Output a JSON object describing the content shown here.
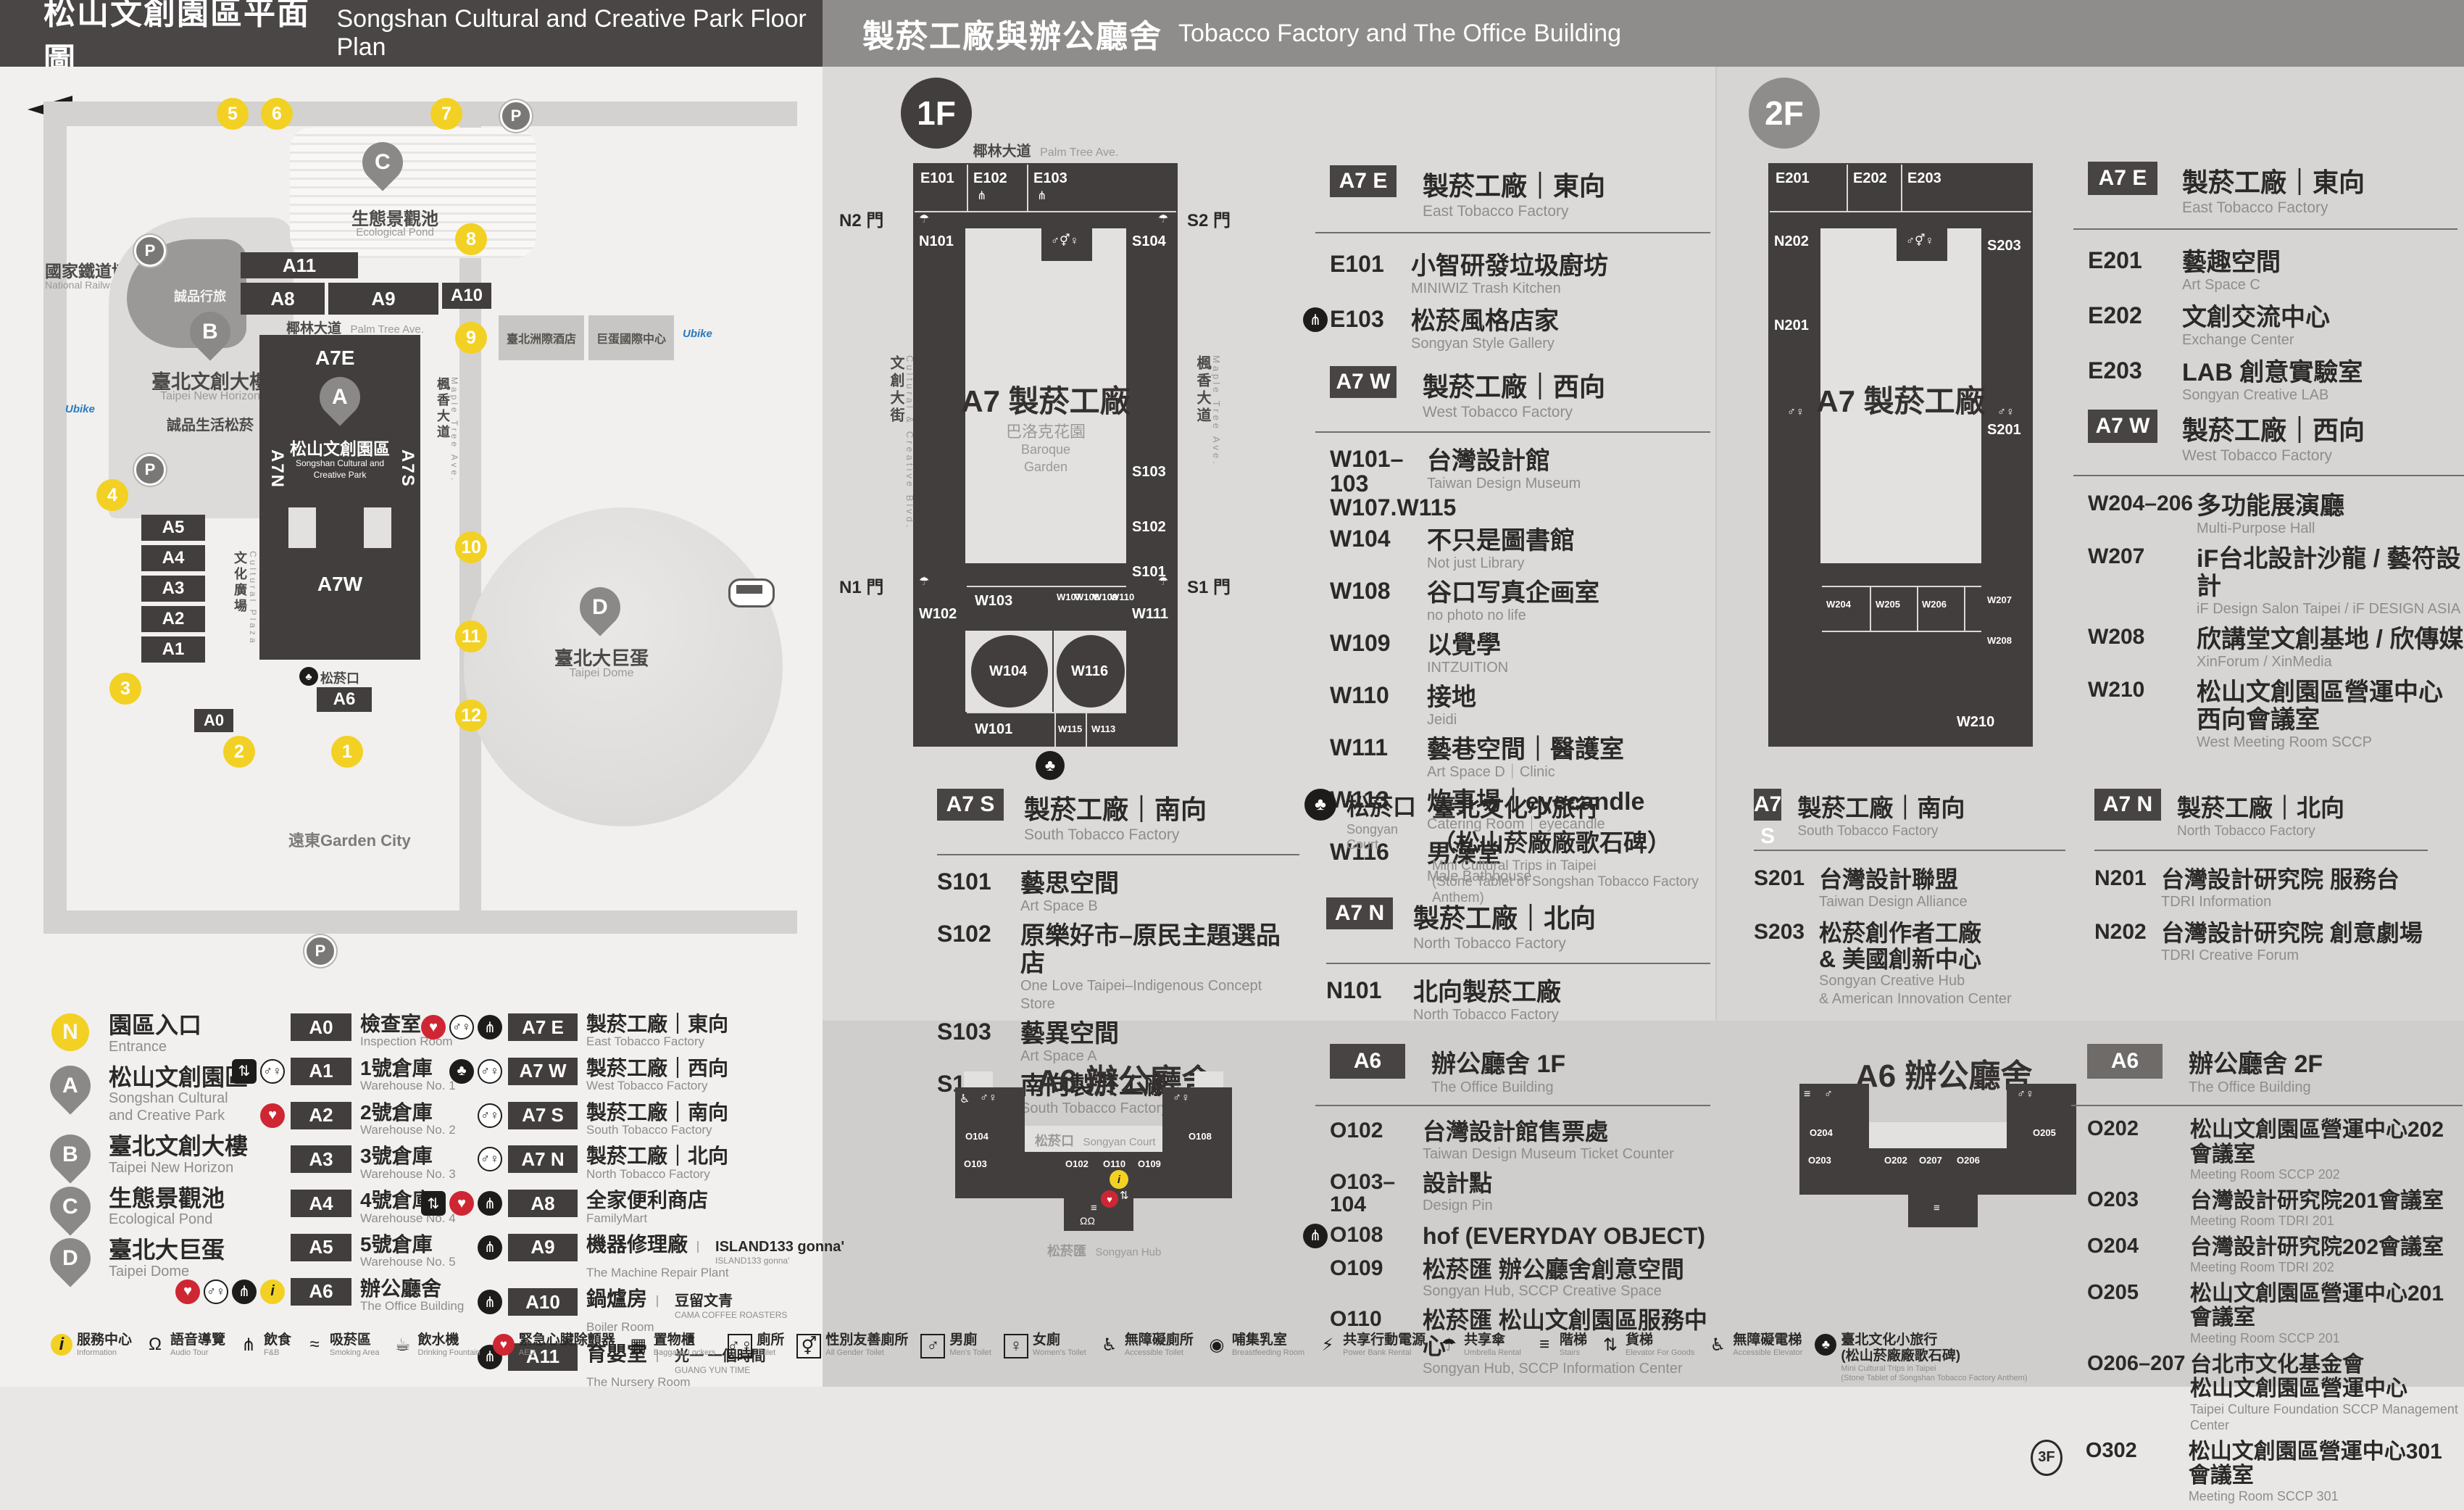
{
  "colors": {
    "accent_yellow": "#f2d124",
    "aed_red": "#cf2633",
    "dark": "#413e3d",
    "header_left_bg": "#4a4646",
    "header_right_bg": "#8f8d8b"
  },
  "icon_glyphs": {
    "information": "i",
    "audio-tour": "Ω",
    "fnb": "⋔",
    "smoking-area": "≈",
    "drinking-fountain": "☕",
    "aed": "♥",
    "baggage-lockers": "▦",
    "toilet": "♂♀",
    "all-gender-toilet": "⚥",
    "mens-toilet": "♂",
    "womens-toilet": "♀",
    "accessible-toilet": "♿",
    "breastfeeding-room": "◉",
    "power-bank-rental": "⚡",
    "umbrella-rental": "☂",
    "stairs": "≡",
    "elevator-for-goods": "⇅",
    "accessible-elevator": "♿",
    "court": "♣",
    "elevator": "⇅",
    "mini-cultural-trips": "♣",
    "parking": "P"
  },
  "header": {
    "left_zh": "松山文創園區平面圖",
    "left_en": "Songshan Cultural and Creative Park Floor Plan",
    "right_zh": "製菸工廠與辦公廳舍",
    "right_en": "Tobacco Factory and The Office Building"
  },
  "map": {
    "railway_museum_zh": "國家鐵道博物館",
    "railway_museum_en": "National Railway Museum",
    "eslite_hotel_zh": "誠品行旅",
    "b_zh": "臺北文創大樓",
    "b_en": "Taipei New Horizon",
    "eslite_store_zh": "誠品生活松菸",
    "c_zh": "生態景觀池",
    "c_en": "Ecological Pond",
    "a_zh": "松山文創園區",
    "a_en1": "Songshan Cultural and",
    "a_en2": "Creative Park",
    "d_zh": "臺北大巨蛋",
    "d_en": "Taipei Dome",
    "hotel_zh": "臺北洲際酒店",
    "dome_center_zh": "巨蛋國際中心",
    "garden_city": "遠東Garden City",
    "court_zh": "松菸口",
    "palm_zh": "椰林大道",
    "palm_en": "Palm Tree Ave.",
    "plaza_zh": "文化廣場",
    "plaza_en": "Cultural Plaza",
    "ccblvd_zh": "文創大街",
    "ccblvd_en": "Cultural & Creative Blvd.",
    "maple_zh": "楓香大道",
    "maple_en": "Maple Tree Ave.",
    "ubike": "Ubike",
    "parking_label": "P",
    "stops": [
      "1",
      "2",
      "3",
      "4",
      "5",
      "6",
      "7",
      "8",
      "9",
      "10",
      "11",
      "12"
    ],
    "bld": {
      "a0": "A0",
      "a1": "A1",
      "a2": "A2",
      "a3": "A3",
      "a4": "A4",
      "a5": "A5",
      "a6": "A6",
      "a8": "A8",
      "a9": "A9",
      "a10": "A10",
      "a11": "A11",
      "a7e": "A7E",
      "a7w": "A7W",
      "a7n": "A7N",
      "a7s": "A7S"
    }
  },
  "floor1": {
    "badge": "1F",
    "plan": {
      "street_top_zh": "椰林大道",
      "street_top_en": "Palm Tree Ave.",
      "street_left_zh": "文創大街",
      "street_left_en": "Cultural & Creative Blvd.",
      "street_right_zh": "楓香大道",
      "street_right_en": "Maple Tree Ave.",
      "center_title": "A7 製菸工廠",
      "garden_zh": "巴洛克花園",
      "garden_en1": "Baroque",
      "garden_en2": "Garden",
      "gates": {
        "n2": "N2 門",
        "s2": "S2 門",
        "n1": "N1 門",
        "s1": "S1 門"
      },
      "rooms": {
        "e101": "E101",
        "e102": "E102",
        "e103": "E103",
        "n101": "N101",
        "s104": "S104",
        "s103": "S103",
        "s102": "S102",
        "s101": "S101",
        "w102": "W102",
        "w103": "W103",
        "w107": "W107",
        "w108": "W108",
        "w109": "W109",
        "w110": "W110",
        "w111": "W111",
        "w104": "W104",
        "w116": "W116",
        "w101": "W101",
        "w115": "W115",
        "w113": "W113"
      }
    },
    "sections": [
      {
        "badge": "A7 E",
        "zh": "製菸工廠｜東向",
        "en": "East Tobacco Factory",
        "items": [
          {
            "code": "E101",
            "zh": "小智研發垃圾廚坊",
            "en": "MINIWIZ Trash Kitchen",
            "icons": []
          },
          {
            "code": "E103",
            "zh": "松菸風格店家",
            "en": "Songyan Style Gallery",
            "icons": [
              "fnb"
            ]
          }
        ]
      },
      {
        "badge": "A7 W",
        "zh": "製菸工廠｜西向",
        "en": "West Tobacco Factory",
        "items": [
          {
            "code": "W101–103",
            "code2": "W107.W115",
            "zh": "台灣設計館",
            "en": "Taiwan Design Museum",
            "icons": []
          },
          {
            "code": "W104",
            "zh": "不只是圖書館",
            "en": "Not just Library",
            "icons": []
          },
          {
            "code": "W108",
            "zh": "谷口写真企画室",
            "en": "no photo no life",
            "icons": []
          },
          {
            "code": "W109",
            "zh": "以覺學",
            "en": "INTZUITION",
            "icons": []
          },
          {
            "code": "W110",
            "zh": "接地",
            "en": "Jeidi",
            "icons": []
          },
          {
            "code": "W111",
            "zh": "藝巷空間｜醫護室",
            "en": "Art Space D｜Clinic",
            "icons": []
          },
          {
            "code": "W113",
            "zh": "炊事場｜eyecandle",
            "en": "Catering Room｜eyecandle",
            "icons": []
          },
          {
            "code": "W116",
            "zh": "男澡堂",
            "en": "Male Bathhouse",
            "icons": []
          }
        ]
      },
      {
        "badge": "A7 S",
        "zh": "製菸工廠｜南向",
        "en": "South Tobacco Factory",
        "items": [
          {
            "code": "S101",
            "zh": "藝思空間",
            "en": "Art Space B",
            "icons": []
          },
          {
            "code": "S102",
            "zh": "原樂好市–原民主題選品店",
            "en": "One Love Taipei–Indigenous Concept Store",
            "icons": []
          },
          {
            "code": "S103",
            "zh": "藝異空間",
            "en": "Art Space A",
            "icons": []
          },
          {
            "code": "S104",
            "zh": "南向製菸工廠",
            "en": "South Tobacco Factory",
            "icons": []
          }
        ]
      },
      {
        "badge": "A7 N",
        "zh": "製菸工廠｜北向",
        "en": "North Tobacco Factory",
        "items": [
          {
            "code": "N101",
            "zh": "北向製菸工廠",
            "en": "North Tobacco Factory",
            "icons": []
          }
        ]
      }
    ],
    "court": {
      "zh": "松菸口",
      "en": "Songyan Court",
      "item_zh1": "臺北文化小旅行",
      "item_zh2": "（松山菸廠廠歌石碑）",
      "item_en1": "Mini Cultural Trips in Taipei",
      "item_en2": "(Stone Tablet of Songshan Tobacco Factory Anthem)"
    }
  },
  "floor2": {
    "badge": "2F",
    "plan": {
      "center_title": "A7 製菸工廠",
      "rooms": {
        "e201": "E201",
        "e202": "E202",
        "e203": "E203",
        "n202": "N202",
        "n201": "N201",
        "s203": "S203",
        "s201": "S201",
        "w204": "W204",
        "w205": "W205",
        "w206": "W206",
        "w207": "W207",
        "w208": "W208",
        "w210": "W210"
      }
    },
    "sections": [
      {
        "badge": "A7 E",
        "zh": "製菸工廠｜東向",
        "en": "East Tobacco Factory",
        "items": [
          {
            "code": "E201",
            "zh": "藝趣空間",
            "en": "Art Space C",
            "icons": []
          },
          {
            "code": "E202",
            "zh": "文創交流中心",
            "en": "Exchange Center",
            "icons": []
          },
          {
            "code": "E203",
            "zh": "LAB 創意實驗室",
            "en": "Songyan Creative LAB",
            "icons": []
          }
        ]
      },
      {
        "badge": "A7 W",
        "zh": "製菸工廠｜西向",
        "en": "West Tobacco Factory",
        "items": [
          {
            "code": "W204–206",
            "zh": "多功能展演廳",
            "en": "Multi-Purpose Hall",
            "icons": []
          },
          {
            "code": "W207",
            "zh": "iF台北設計沙龍 / 藝符設計",
            "en": "iF Design Salon Taipei / iF DESIGN ASIA",
            "icons": []
          },
          {
            "code": "W208",
            "zh": "欣講堂文創基地 / 欣傳媒",
            "en": "XinForum / XinMedia",
            "icons": []
          },
          {
            "code": "W210",
            "zh": "松山文創園區營運中心",
            "zh2": "西向會議室",
            "en": "West Meeting Room SCCP",
            "icons": []
          }
        ]
      },
      {
        "badge": "A7 S",
        "zh": "製菸工廠｜南向",
        "en": "South Tobacco Factory",
        "items": [
          {
            "code": "S201",
            "zh": "台灣設計聯盟",
            "en": "Taiwan Design Alliance",
            "icons": []
          },
          {
            "code": "S203",
            "zh": "松菸創作者工廠",
            "zh2": "& 美國創新中心",
            "en": "Songyan Creative Hub",
            "en2": "& American Innovation Center",
            "icons": []
          }
        ]
      },
      {
        "badge": "A7 N",
        "zh": "製菸工廠｜北向",
        "en": "North Tobacco Factory",
        "items": [
          {
            "code": "N201",
            "zh": "台灣設計研究院 服務台",
            "en": "TDRI Information",
            "icons": []
          },
          {
            "code": "N202",
            "zh": "台灣設計研究院 創意劇場",
            "en": "TDRI Creative Forum",
            "icons": []
          }
        ]
      }
    ]
  },
  "office1f": {
    "badge": "A6",
    "zh": "辦公廳舍 1F",
    "en": "The Office Building",
    "plan": {
      "title": "A6 辦公廳舍",
      "court_zh": "松菸口",
      "court_en": "Songyan Court",
      "hub_zh": "松菸匯",
      "hub_en": "Songyan Hub",
      "rooms": {
        "o104": "O104",
        "o103": "O103",
        "o102": "O102",
        "o110": "O110",
        "o109": "O109",
        "o108": "O108"
      }
    },
    "items": [
      {
        "code": "O102",
        "zh": "台灣設計館售票處",
        "en": "Taiwan Design Museum Ticket Counter",
        "icons": []
      },
      {
        "code": "O103–104",
        "zh": "設計點",
        "en": "Design Pin",
        "icons": []
      },
      {
        "code": "O108",
        "zh": "hof (EVERYDAY OBJECT)",
        "icons": [
          "fnb"
        ]
      },
      {
        "code": "O109",
        "zh": "松菸匯 辦公廳舍創意空間",
        "en": "Songyan Hub, SCCP Creative Space",
        "icons": []
      },
      {
        "code": "O110",
        "zh": "松菸匯 松山文創園區服務中心",
        "en": "Songyan Hub, SCCP Information Center",
        "icons": []
      }
    ]
  },
  "office2f": {
    "badge": "A6",
    "zh": "辦公廳舍 2F",
    "en": "The Office Building",
    "plan": {
      "title": "A6 辦公廳舍",
      "rooms": {
        "o204": "O204",
        "o203": "O203",
        "o202": "O202",
        "o207": "O207",
        "o206": "O206",
        "o205": "O205"
      }
    },
    "items": [
      {
        "code": "O202",
        "zh": "松山文創園區營運中心202會議室",
        "en": "Meeting Room SCCP 202",
        "icons": []
      },
      {
        "code": "O203",
        "zh": "台灣設計研究院201會議室",
        "en": "Meeting Room TDRI 201",
        "icons": []
      },
      {
        "code": "O204",
        "zh": "台灣設計研究院202會議室",
        "en": "Meeting Room TDRI 202",
        "icons": []
      },
      {
        "code": "O205",
        "zh": "松山文創園區營運中心201會議室",
        "en": "Meeting Room SCCP 201",
        "icons": []
      },
      {
        "code": "O206–207",
        "zh": "台北市文化基金會",
        "zh2": "松山文創園區營運中心",
        "en": "Taipei Culture Foundation SCCP Management Center",
        "icons": []
      },
      {
        "code": "O302",
        "prefix": "3F",
        "zh": "松山文創園區營運中心301會議室",
        "en": "Meeting Room SCCP 301",
        "icons": []
      }
    ]
  },
  "legend": {
    "points": [
      {
        "key": "N",
        "circle": "y",
        "zh": "園區入口",
        "en": "Entrance"
      },
      {
        "key": "A",
        "pin": "y",
        "zh": "松山文創園區",
        "en": "Songshan Cultural",
        "en2": "and Creative Park"
      },
      {
        "key": "B",
        "pin": "y",
        "zh": "臺北文創大樓",
        "en": "Taipei New Horizon"
      },
      {
        "key": "C",
        "pin": "y",
        "zh": "生態景觀池",
        "en": "Ecological Pond"
      },
      {
        "key": "D",
        "pin": "y",
        "zh": "臺北大巨蛋",
        "en": "Taipei Dome"
      }
    ],
    "buildings": [
      {
        "code": "A0",
        "zh": "檢查室",
        "en": "Inspection Room",
        "icons": []
      },
      {
        "code": "A1",
        "zh": "1號倉庫",
        "en": "Warehouse No. 1",
        "icons": [
          "elevator",
          "toilet"
        ]
      },
      {
        "code": "A2",
        "zh": "2號倉庫",
        "en": "Warehouse No. 2",
        "icons": [
          "aed"
        ]
      },
      {
        "code": "A3",
        "zh": "3號倉庫",
        "en": "Warehouse No. 3",
        "icons": []
      },
      {
        "code": "A4",
        "zh": "4號倉庫",
        "en": "Warehouse No. 4",
        "icons": []
      },
      {
        "code": "A5",
        "zh": "5號倉庫",
        "en": "Warehouse No. 5",
        "icons": []
      },
      {
        "code": "A6",
        "zh": "辦公廳舍",
        "en": "The Office Building",
        "icons": [
          "aed",
          "toilet",
          "fnb",
          "information"
        ]
      }
    ],
    "factory": [
      {
        "code": "A7 E",
        "zh": "製菸工廠｜東向",
        "en": "East Tobacco Factory",
        "icons": [
          "aed",
          "toilet",
          "fnb"
        ]
      },
      {
        "code": "A7 W",
        "zh": "製菸工廠｜西向",
        "en": "West Tobacco Factory",
        "icons": [
          "court",
          "toilet"
        ]
      },
      {
        "code": "A7 S",
        "zh": "製菸工廠｜南向",
        "en": "South Tobacco Factory",
        "icons": [
          "toilet"
        ]
      },
      {
        "code": "A7 N",
        "zh": "製菸工廠｜北向",
        "en": "North Tobacco Factory",
        "icons": [
          "toilet"
        ]
      },
      {
        "code": "A8",
        "zh": "全家便利商店",
        "en": "FamilyMart",
        "icons": [
          "elevator",
          "aed",
          "fnb"
        ]
      },
      {
        "code": "A9",
        "zh": "機器修理廠",
        "en": "The Machine Repair Plant",
        "brand": "ISLAND133 gonna'",
        "brand_sub": "ISLAND133 gonna'",
        "icons": [
          "fnb"
        ]
      },
      {
        "code": "A10",
        "zh": "鍋爐房",
        "en": "Boiler Room",
        "brand": "豆留文青",
        "brand_sub": "CAMA COFFEE ROASTERS",
        "icons": [
          "fnb"
        ]
      },
      {
        "code": "A11",
        "zh": "育嬰室",
        "en": "The Nursery Room",
        "brand": "光一 一個時間",
        "brand_sub": "GUANG YUN TIME",
        "icons": [
          "fnb"
        ]
      }
    ]
  },
  "footer": [
    {
      "icon": "information",
      "zh": "服務中心",
      "en": "Information"
    },
    {
      "icon": "audio-tour",
      "zh": "語音導覽",
      "en": "Audio Tour"
    },
    {
      "icon": "fnb",
      "zh": "飲食",
      "en": "F&B"
    },
    {
      "icon": "smoking-area",
      "zh": "吸菸區",
      "en": "Smoking Area"
    },
    {
      "icon": "drinking-fountain",
      "zh": "飲水機",
      "en": "Drinking Fountain"
    },
    {
      "icon": "aed",
      "zh": "緊急心臟除顫器",
      "en": "AED"
    },
    {
      "icon": "baggage-lockers",
      "zh": "置物櫃",
      "en": "Baggage Lockers"
    },
    {
      "icon": "toilet",
      "zh": "廁所",
      "en": "Toilet"
    },
    {
      "icon": "all-gender-toilet",
      "zh": "性別友善廁所",
      "en": "All Gender Toilet"
    },
    {
      "icon": "mens-toilet",
      "zh": "男廁",
      "en": "Men's Toilet"
    },
    {
      "icon": "womens-toilet",
      "zh": "女廁",
      "en": "Women's Toilet"
    },
    {
      "icon": "accessible-toilet",
      "zh": "無障礙廁所",
      "en": "Accessible Toilet"
    },
    {
      "icon": "breastfeeding-room",
      "zh": "哺集乳室",
      "en": "Breastfeeding Room"
    },
    {
      "icon": "power-bank-rental",
      "zh": "共享行動電源",
      "en": "Power Bank Rental"
    },
    {
      "icon": "umbrella-rental",
      "zh": "共享傘",
      "en": "Umbrella Rental"
    },
    {
      "icon": "stairs",
      "zh": "階梯",
      "en": "Stairs"
    },
    {
      "icon": "elevator-for-goods",
      "zh": "貨梯",
      "en": "Elevator For Goods"
    },
    {
      "icon": "accessible-elevator",
      "zh": "無障礙電梯",
      "en": "Accessible Elevator"
    },
    {
      "icon": "mini-cultural-trips",
      "zh": "臺北文化小旅行",
      "zh2": "(松山菸廠廠歌石碑)",
      "en": "Mini Cultural Trips in Taipei",
      "en2": "(Stone Tablet of Songshan Tobacco Factory Anthem)"
    }
  ]
}
